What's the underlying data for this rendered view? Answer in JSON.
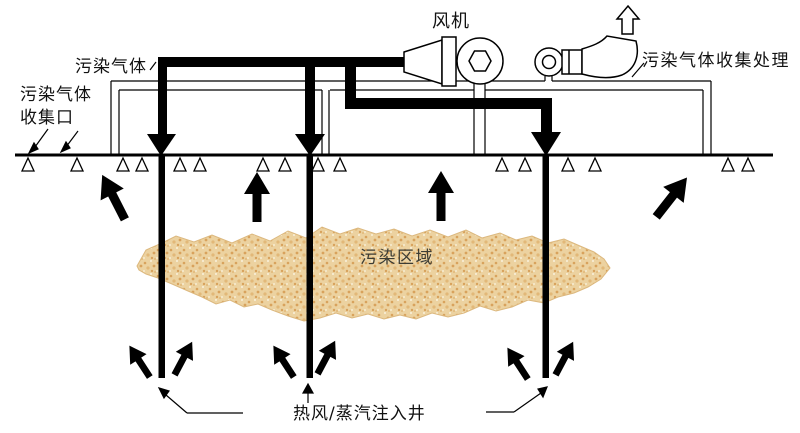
{
  "labels": {
    "fan": "风机",
    "polluted_gas": "污染气体",
    "gas_collection_port_line1": "污染气体",
    "gas_collection_port_line2": "收集口",
    "gas_collection_treatment": "污染气体收集处理",
    "contaminated_area": "污染区域",
    "injection_well": "热风/蒸汽注入井"
  },
  "colors": {
    "line": "#000000",
    "background": "#ffffff",
    "soil_base": "#ecd2a0",
    "soil_speckle_dark": "#d8a25c",
    "soil_speckle_mid": "#e2b878",
    "soil_speckle_light": "#f7ecd2",
    "soil_edge": "#dcb87e"
  }
}
